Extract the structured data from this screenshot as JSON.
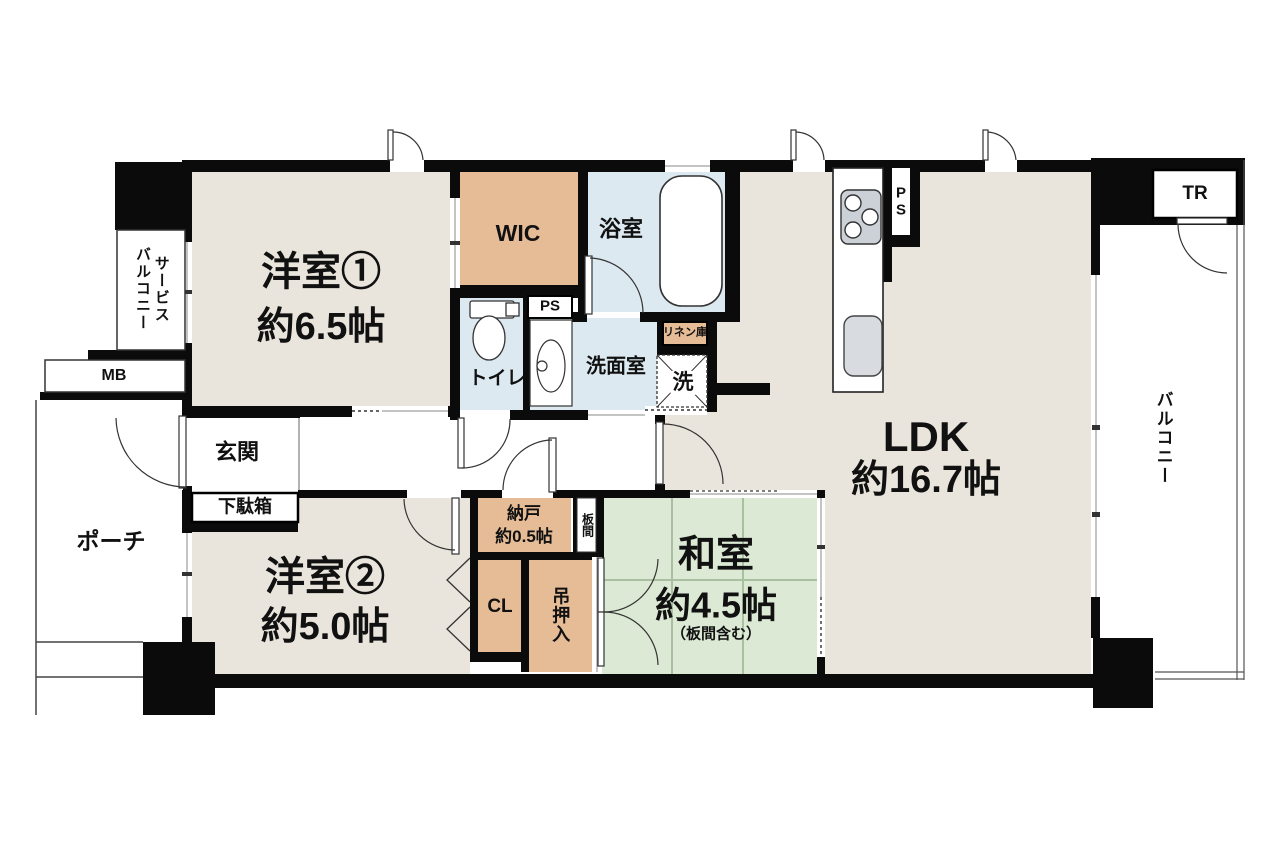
{
  "title": "マンション間取り図",
  "rooms": {
    "yoshitsu1": {
      "name": "洋室①",
      "size": "約6.5帖"
    },
    "yoshitsu2": {
      "name": "洋室②",
      "size": "約5.0帖"
    },
    "washitsu": {
      "name": "和室",
      "size": "約4.5帖",
      "note": "（板間含む）"
    },
    "ldk": {
      "name": "LDK",
      "size": "約16.7帖"
    },
    "wic": "WIC",
    "bath": "浴室",
    "toilet": "トイレ",
    "senmen": "洗面室",
    "linen": "リネン庫",
    "washer": "洗",
    "ps": "PS",
    "ps_kitchen": "P\nS",
    "nando": {
      "name": "納戸",
      "size": "約0.5帖"
    },
    "itanoma": "板間",
    "cl": "CL",
    "tsurioshiire": "吊押入",
    "genkan": "玄関",
    "getabako": "下駄箱",
    "porch": "ポーチ",
    "mb": "MB",
    "service_balcony": "サービス\nバルコニー",
    "balcony": "バルコニー",
    "tr": "TR"
  },
  "colors": {
    "room_beige": "#EAE5DC",
    "tatami_green": "#DCE9D4",
    "tatami_line": "#A9C0A1",
    "wet_blue": "#DCE9F1",
    "storage_orange": "#E6BC96",
    "wall_black": "#0B0B0B",
    "appliance_gray": "#CBD1D7",
    "sink_gray": "#D8DCE0"
  }
}
